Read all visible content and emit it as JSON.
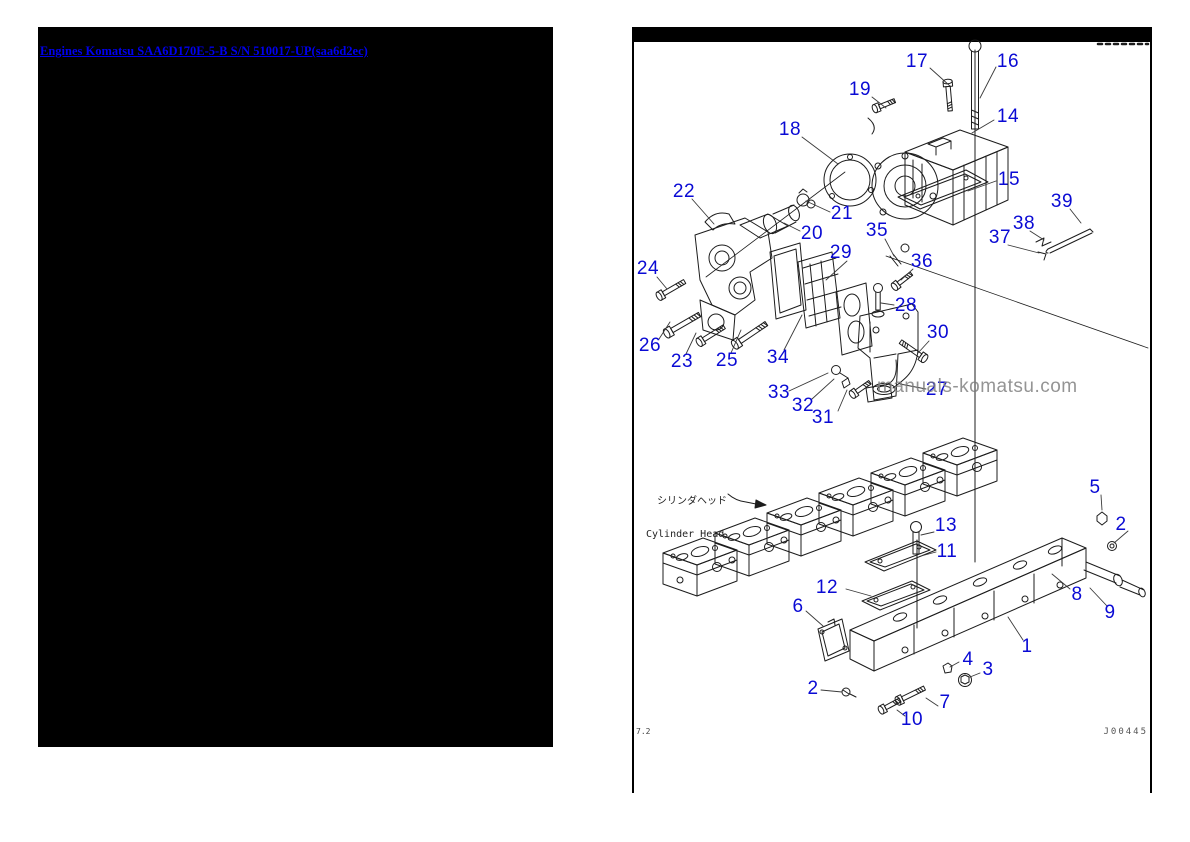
{
  "left_panel": {
    "link": "Engines Komatsu SAA6D170E-5-B S/N 510017-UP(saa6d2ec)"
  },
  "right_panel": {
    "caption_jp": "シリンダヘッド",
    "caption_en": "Cylinder Head",
    "watermark": "manuals-komatsu.com",
    "page_ref": "7.2",
    "figure_code": "J00445",
    "labels": [
      {
        "n": "17",
        "cx": 917,
        "cy": 62,
        "x1": 930,
        "y1": 68,
        "x2": 950,
        "y2": 86
      },
      {
        "n": "16",
        "cx": 1008,
        "cy": 62,
        "x1": 996,
        "y1": 67,
        "x2": 980,
        "y2": 98
      },
      {
        "n": "19",
        "cx": 860,
        "cy": 90,
        "x1": 872,
        "y1": 97,
        "x2": 886,
        "y2": 108
      },
      {
        "n": "14",
        "cx": 1008,
        "cy": 117,
        "x1": 994,
        "y1": 120,
        "x2": 972,
        "y2": 133
      },
      {
        "n": "18",
        "cx": 790,
        "cy": 130,
        "x1": 802,
        "y1": 137,
        "x2": 838,
        "y2": 164
      },
      {
        "n": "15",
        "cx": 1009,
        "cy": 180,
        "x1": 996,
        "y1": 181,
        "x2": 968,
        "y2": 191
      },
      {
        "n": "22",
        "cx": 684,
        "cy": 192,
        "x1": 692,
        "y1": 199,
        "x2": 714,
        "y2": 224
      },
      {
        "n": "21",
        "cx": 842,
        "cy": 214,
        "x1": 830,
        "y1": 212,
        "x2": 806,
        "y2": 201
      },
      {
        "n": "20",
        "cx": 812,
        "cy": 234,
        "x1": 800,
        "y1": 231,
        "x2": 784,
        "y2": 223
      },
      {
        "n": "39",
        "cx": 1062,
        "cy": 202,
        "x1": 1070,
        "y1": 209,
        "x2": 1081,
        "y2": 223
      },
      {
        "n": "38",
        "cx": 1024,
        "cy": 224,
        "x1": 1030,
        "y1": 231,
        "x2": 1044,
        "y2": 240
      },
      {
        "n": "37",
        "cx": 1000,
        "cy": 238,
        "x1": 1008,
        "y1": 245,
        "x2": 1039,
        "y2": 253
      },
      {
        "n": "35",
        "cx": 877,
        "cy": 231,
        "x1": 885,
        "y1": 239,
        "x2": 894,
        "y2": 256
      },
      {
        "n": "36",
        "cx": 922,
        "cy": 262,
        "x1": 913,
        "y1": 269,
        "x2": 901,
        "y2": 280
      },
      {
        "n": "29",
        "cx": 841,
        "cy": 253,
        "x1": 847,
        "y1": 261,
        "x2": 826,
        "y2": 280
      },
      {
        "n": "28",
        "cx": 906,
        "cy": 306,
        "x1": 894,
        "y1": 305,
        "x2": 881,
        "y2": 303
      },
      {
        "n": "24",
        "cx": 648,
        "cy": 269,
        "x1": 657,
        "y1": 277,
        "x2": 667,
        "y2": 289
      },
      {
        "n": "30",
        "cx": 938,
        "cy": 333,
        "x1": 929,
        "y1": 341,
        "x2": 918,
        "y2": 353
      },
      {
        "n": "26",
        "cx": 650,
        "cy": 346,
        "x1": 659,
        "y1": 339,
        "x2": 670,
        "y2": 322
      },
      {
        "n": "23",
        "cx": 682,
        "cy": 362,
        "x1": 686,
        "y1": 354,
        "x2": 696,
        "y2": 333
      },
      {
        "n": "25",
        "cx": 727,
        "cy": 361,
        "x1": 731,
        "y1": 353,
        "x2": 741,
        "y2": 330
      },
      {
        "n": "34",
        "cx": 778,
        "cy": 358,
        "x1": 784,
        "y1": 350,
        "x2": 802,
        "y2": 315
      },
      {
        "n": "33",
        "cx": 779,
        "cy": 393,
        "x1": 789,
        "y1": 391,
        "x2": 828,
        "y2": 373
      },
      {
        "n": "32",
        "cx": 803,
        "cy": 406,
        "x1": 812,
        "y1": 399,
        "x2": 834,
        "y2": 379
      },
      {
        "n": "31",
        "cx": 823,
        "cy": 418,
        "x1": 838,
        "y1": 411,
        "x2": 847,
        "y2": 390
      },
      {
        "n": "27",
        "cx": 937,
        "cy": 390,
        "x1": 926,
        "y1": 389,
        "x2": 900,
        "y2": 384
      },
      {
        "n": "13",
        "cx": 946,
        "cy": 526,
        "x1": 934,
        "y1": 532,
        "x2": 921,
        "y2": 535
      },
      {
        "n": "11",
        "cx": 947,
        "cy": 552,
        "x1": 936,
        "y1": 552,
        "x2": 921,
        "y2": 556
      },
      {
        "n": "12",
        "cx": 827,
        "cy": 588,
        "x1": 846,
        "y1": 589,
        "x2": 871,
        "y2": 596
      },
      {
        "n": "6",
        "cx": 798,
        "cy": 607,
        "x1": 806,
        "y1": 611,
        "x2": 823,
        "y2": 626
      },
      {
        "n": "5",
        "cx": 1095,
        "cy": 488,
        "x1": 1101,
        "y1": 495,
        "x2": 1102,
        "y2": 510
      },
      {
        "n": "2",
        "cx": 1121,
        "cy": 525,
        "x1": 1128,
        "y1": 531,
        "x2": 1114,
        "y2": 543
      },
      {
        "n": "8",
        "cx": 1077,
        "cy": 595,
        "x1": 1070,
        "y1": 589,
        "x2": 1052,
        "y2": 574
      },
      {
        "n": "9",
        "cx": 1110,
        "cy": 613,
        "x1": 1107,
        "y1": 606,
        "x2": 1090,
        "y2": 588
      },
      {
        "n": "1",
        "cx": 1027,
        "cy": 647,
        "x1": 1023,
        "y1": 640,
        "x2": 1008,
        "y2": 617
      },
      {
        "n": "4",
        "cx": 968,
        "cy": 660,
        "x1": 959,
        "y1": 662,
        "x2": 950,
        "y2": 667
      },
      {
        "n": "3",
        "cx": 988,
        "cy": 670,
        "x1": 980,
        "y1": 673,
        "x2": 970,
        "y2": 677
      },
      {
        "n": "2",
        "cx": 813,
        "cy": 689,
        "x1": 821,
        "y1": 690,
        "x2": 842,
        "y2": 692
      },
      {
        "n": "7",
        "cx": 945,
        "cy": 703,
        "x1": 938,
        "y1": 706,
        "x2": 926,
        "y2": 698
      },
      {
        "n": "10",
        "cx": 912,
        "cy": 720,
        "x1": 905,
        "y1": 716,
        "x2": 897,
        "y2": 710
      }
    ]
  },
  "colors": {
    "label_blue": "#0a0ad4",
    "link_blue": "#0000ee",
    "line_dark": "#1c1c1c",
    "watermark_gray": "#7d7d7d",
    "frame_black": "#000000"
  }
}
